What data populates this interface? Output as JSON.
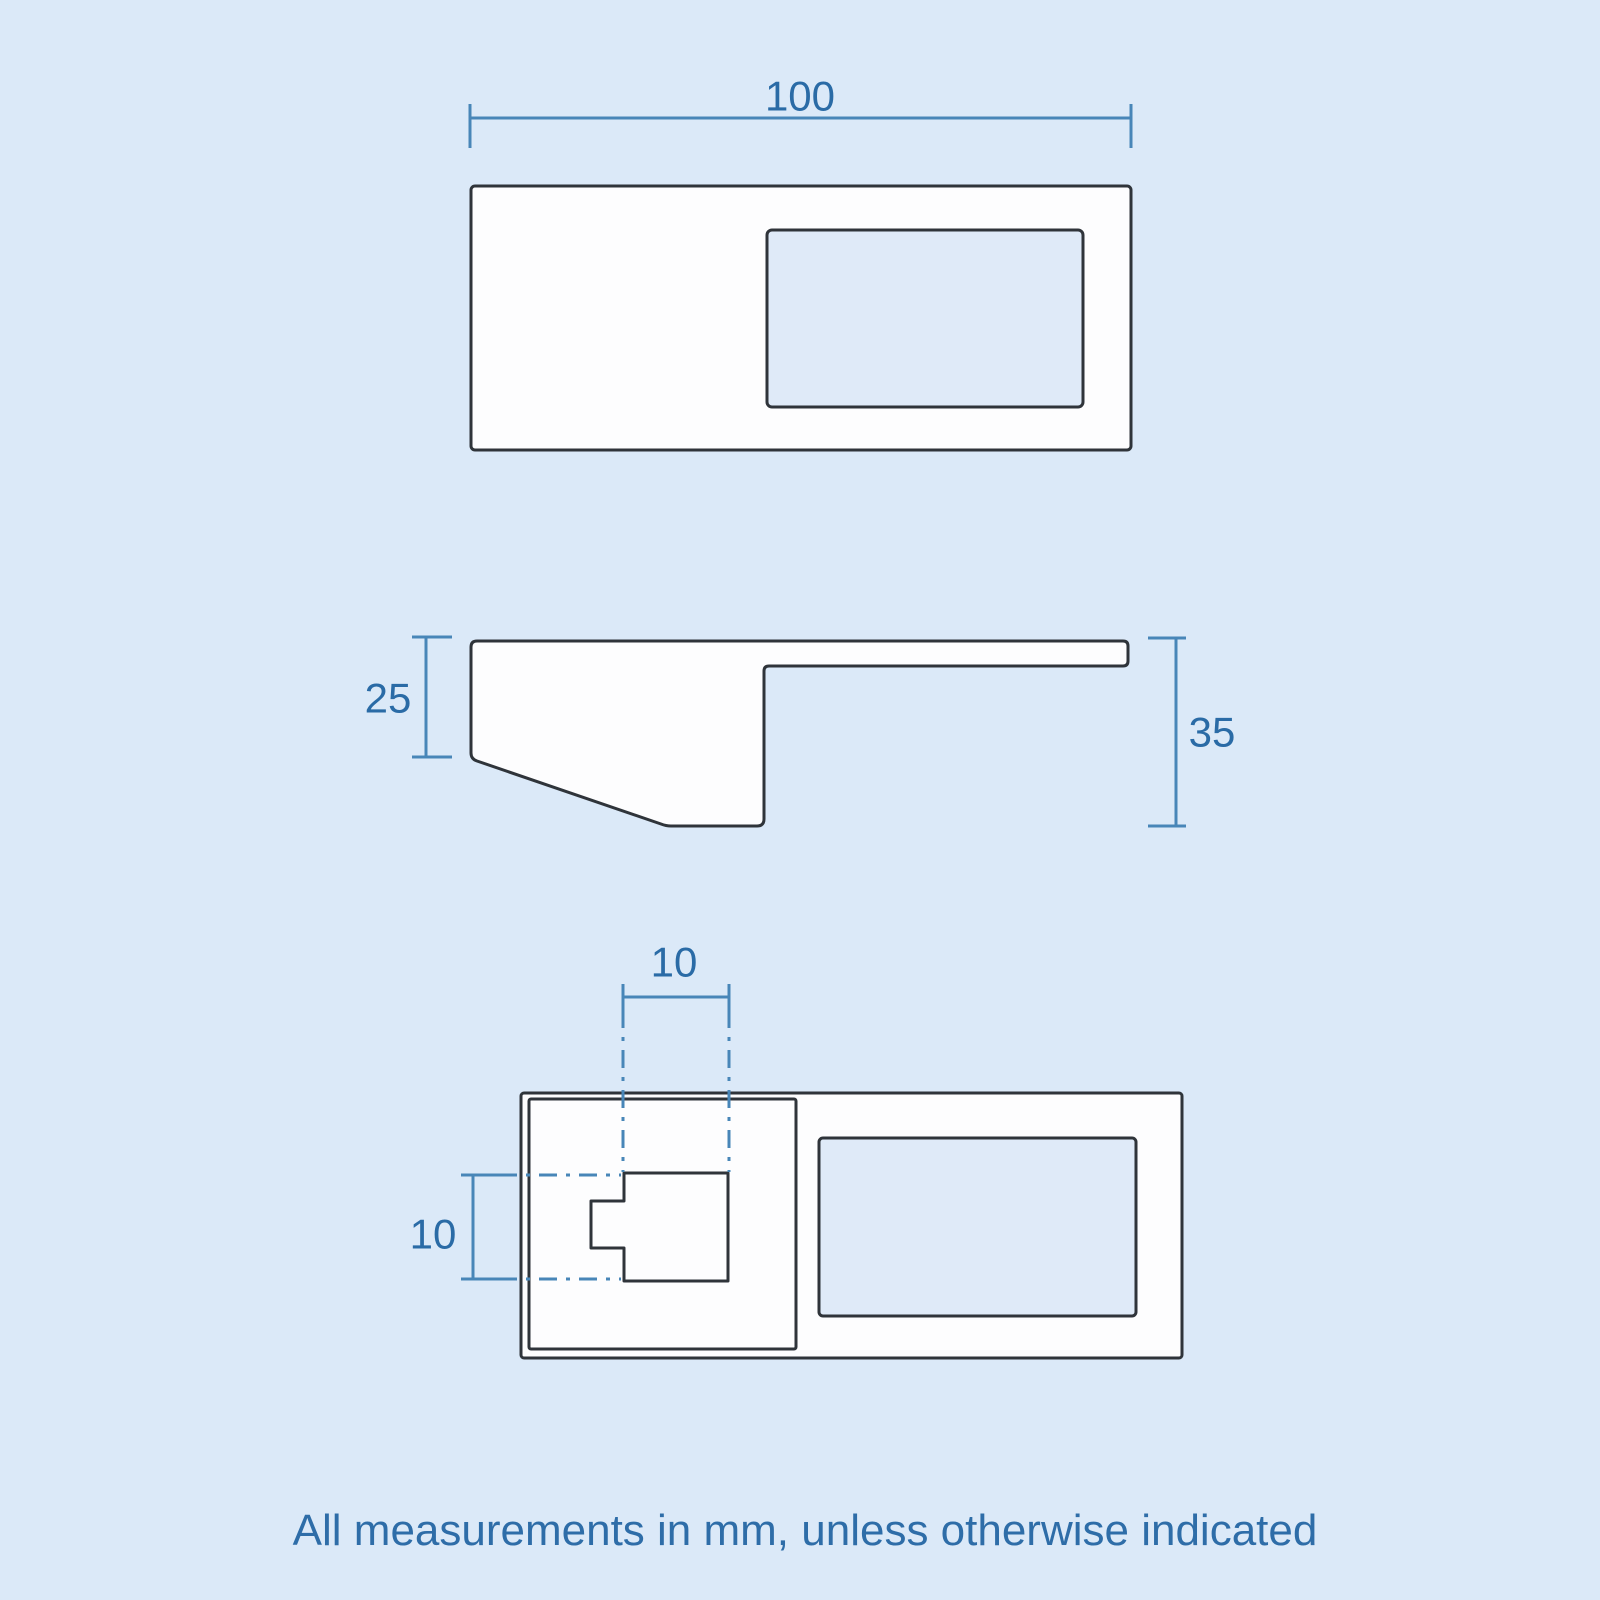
{
  "colors": {
    "background": "#dbe9f8",
    "outline": "#2f343a",
    "shape_fill": "#fdfdfe",
    "recess_fill": "#dfeaf8",
    "dimension_line": "#4886b8",
    "dimension_text": "#2a6ba6",
    "caption_text": "#2e6da8"
  },
  "views": {
    "top": {
      "width_dim": "100"
    },
    "side": {
      "left_depth_dim": "25",
      "right_height_dim": "35"
    },
    "plan": {
      "notch_width_dim": "10",
      "notch_height_dim": "10"
    }
  },
  "caption": "All measurements in mm, unless otherwise indicated"
}
